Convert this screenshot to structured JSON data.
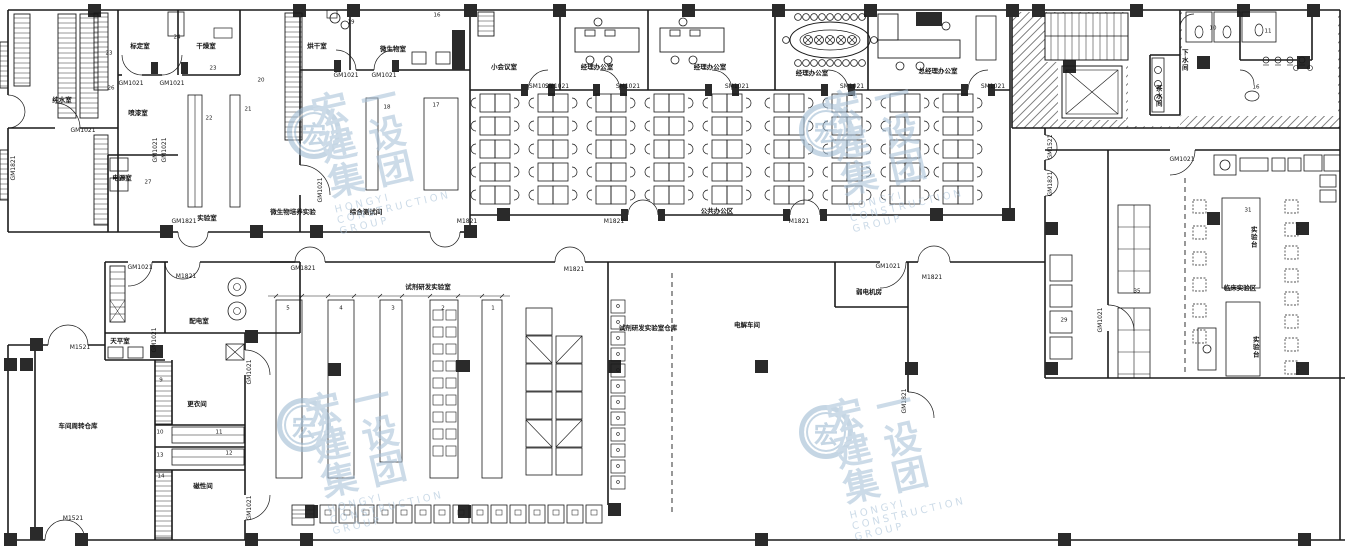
{
  "drawing": {
    "type": "architectural-floor-plan",
    "line_color": "#1a1a1a",
    "column_color": "#2a2a2a",
    "watermark_color": "#9db9d2"
  },
  "watermark": {
    "cn": "宏一建设集团",
    "en": "HONGYI CONSTRUCTION GROUP",
    "logo_char": "宏"
  },
  "labels": [
    {
      "k": "room",
      "t": "纯水室",
      "x": 62,
      "y": 100
    },
    {
      "k": "room",
      "t": "标定室",
      "x": 140,
      "y": 46
    },
    {
      "k": "room",
      "t": "干燥室",
      "x": 206,
      "y": 46
    },
    {
      "k": "room",
      "t": "喷漆室",
      "x": 138,
      "y": 113
    },
    {
      "k": "room",
      "t": "电源室",
      "x": 122,
      "y": 178
    },
    {
      "k": "room",
      "t": "实验室",
      "x": 207,
      "y": 218
    },
    {
      "k": "room",
      "t": "烘干室",
      "x": 317,
      "y": 46
    },
    {
      "k": "room",
      "t": "微生物室",
      "x": 393,
      "y": 49
    },
    {
      "k": "room",
      "t": "综合测试间",
      "x": 366,
      "y": 212
    },
    {
      "k": "room",
      "t": "微生物培养实验",
      "x": 293,
      "y": 212
    },
    {
      "k": "room",
      "t": "小会议室",
      "x": 504,
      "y": 67
    },
    {
      "k": "room",
      "t": "经理办公室",
      "x": 597,
      "y": 67
    },
    {
      "k": "room",
      "t": "经理办公室",
      "x": 710,
      "y": 67
    },
    {
      "k": "room",
      "t": "经理办公室",
      "x": 812,
      "y": 73
    },
    {
      "k": "room",
      "t": "总经理办公室",
      "x": 938,
      "y": 71
    },
    {
      "k": "room",
      "t": "公共办公区",
      "x": 717,
      "y": 211
    },
    {
      "k": "room",
      "t": "茶水间",
      "x": 1158,
      "y": 96,
      "v": 1
    },
    {
      "k": "room",
      "t": "下水间",
      "x": 1184,
      "y": 60,
      "v": 1
    },
    {
      "k": "room",
      "t": "临床实验区",
      "x": 1240,
      "y": 288
    },
    {
      "k": "room",
      "t": "实验台",
      "x": 1253,
      "y": 237,
      "v": 1
    },
    {
      "k": "room",
      "t": "实验台",
      "x": 1255,
      "y": 347,
      "v": 1
    },
    {
      "k": "room",
      "t": "天平室",
      "x": 120,
      "y": 341
    },
    {
      "k": "room",
      "t": "配电室",
      "x": 199,
      "y": 321
    },
    {
      "k": "room",
      "t": "车间周转仓库",
      "x": 78,
      "y": 426
    },
    {
      "k": "room",
      "t": "更衣间",
      "x": 197,
      "y": 404
    },
    {
      "k": "room",
      "t": "磁性间",
      "x": 203,
      "y": 486
    },
    {
      "k": "room",
      "t": "试剂研发实验室",
      "x": 428,
      "y": 287
    },
    {
      "k": "room",
      "t": "试剂研发实验室仓库",
      "x": 648,
      "y": 328
    },
    {
      "k": "room",
      "t": "电解车间",
      "x": 747,
      "y": 325
    },
    {
      "k": "room",
      "t": "弱电机房",
      "x": 869,
      "y": 292
    },
    {
      "k": "door",
      "t": "GM1021",
      "x": 131,
      "y": 84
    },
    {
      "k": "door",
      "t": "GM1021",
      "x": 172,
      "y": 84
    },
    {
      "k": "door",
      "t": "GM1021",
      "x": 83,
      "y": 131
    },
    {
      "k": "door",
      "t": "GM1821",
      "x": 14,
      "y": 168,
      "r": 1
    },
    {
      "k": "door",
      "t": "GM1021",
      "x": 156,
      "y": 150,
      "r": 1
    },
    {
      "k": "door",
      "t": "GM1021",
      "x": 165,
      "y": 150,
      "r": 1
    },
    {
      "k": "door",
      "t": "GM1821",
      "x": 184,
      "y": 222
    },
    {
      "k": "door",
      "t": "GM1021",
      "x": 321,
      "y": 190,
      "r": 1
    },
    {
      "k": "door",
      "t": "GM1021",
      "x": 346,
      "y": 76
    },
    {
      "k": "door",
      "t": "GM1021",
      "x": 384,
      "y": 76
    },
    {
      "k": "door",
      "t": "M1821",
      "x": 467,
      "y": 222
    },
    {
      "k": "door",
      "t": "SM1021",
      "x": 541,
      "y": 87
    },
    {
      "k": "door",
      "t": "SM1021",
      "x": 557,
      "y": 87
    },
    {
      "k": "door",
      "t": "SM1021",
      "x": 628,
      "y": 87
    },
    {
      "k": "door",
      "t": "SM1021",
      "x": 737,
      "y": 87
    },
    {
      "k": "door",
      "t": "SM1021",
      "x": 852,
      "y": 87
    },
    {
      "k": "door",
      "t": "SM1021",
      "x": 993,
      "y": 87
    },
    {
      "k": "door",
      "t": "M1821",
      "x": 614,
      "y": 222
    },
    {
      "k": "door",
      "t": "M1821",
      "x": 799,
      "y": 222
    },
    {
      "k": "door",
      "t": "GM1521",
      "x": 1051,
      "y": 147,
      "r": 1
    },
    {
      "k": "door",
      "t": "GM1821",
      "x": 1051,
      "y": 184,
      "r": 1
    },
    {
      "k": "door",
      "t": "GM1021",
      "x": 1182,
      "y": 160
    },
    {
      "k": "door",
      "t": "GM1021",
      "x": 1101,
      "y": 320,
      "r": 1
    },
    {
      "k": "door",
      "t": "GM1021",
      "x": 140,
      "y": 268
    },
    {
      "k": "door",
      "t": "M1821",
      "x": 186,
      "y": 277
    },
    {
      "k": "door",
      "t": "GM1021",
      "x": 155,
      "y": 340,
      "r": 1
    },
    {
      "k": "door",
      "t": "GM1021",
      "x": 250,
      "y": 372,
      "r": 1
    },
    {
      "k": "door",
      "t": "GM1021",
      "x": 250,
      "y": 508,
      "r": 1
    },
    {
      "k": "door",
      "t": "M1521",
      "x": 80,
      "y": 348
    },
    {
      "k": "door",
      "t": "M1521",
      "x": 73,
      "y": 519
    },
    {
      "k": "door",
      "t": "GM1821",
      "x": 303,
      "y": 269
    },
    {
      "k": "door",
      "t": "M1821",
      "x": 574,
      "y": 270
    },
    {
      "k": "door",
      "t": "GM1021",
      "x": 888,
      "y": 267
    },
    {
      "k": "door",
      "t": "M1821",
      "x": 932,
      "y": 278
    },
    {
      "k": "door",
      "t": "GM1821",
      "x": 905,
      "y": 401,
      "r": 1
    },
    {
      "k": "num",
      "t": "23",
      "x": 109,
      "y": 54
    },
    {
      "k": "num",
      "t": "24",
      "x": 177,
      "y": 38
    },
    {
      "k": "num",
      "t": "26",
      "x": 111,
      "y": 89
    },
    {
      "k": "num",
      "t": "23",
      "x": 213,
      "y": 69
    },
    {
      "k": "num",
      "t": "20",
      "x": 261,
      "y": 81
    },
    {
      "k": "num",
      "t": "22",
      "x": 209,
      "y": 119
    },
    {
      "k": "num",
      "t": "21",
      "x": 248,
      "y": 110
    },
    {
      "k": "num",
      "t": "27",
      "x": 148,
      "y": 183
    },
    {
      "k": "num",
      "t": "19",
      "x": 351,
      "y": 23
    },
    {
      "k": "num",
      "t": "16",
      "x": 437,
      "y": 16
    },
    {
      "k": "num",
      "t": "18",
      "x": 387,
      "y": 108
    },
    {
      "k": "num",
      "t": "17",
      "x": 436,
      "y": 106
    },
    {
      "k": "num",
      "t": "10",
      "x": 1213,
      "y": 29
    },
    {
      "k": "num",
      "t": "11",
      "x": 1268,
      "y": 32
    },
    {
      "k": "num",
      "t": "16",
      "x": 1256,
      "y": 88
    },
    {
      "k": "num",
      "t": "29",
      "x": 1064,
      "y": 321
    },
    {
      "k": "num",
      "t": "35",
      "x": 1137,
      "y": 292
    },
    {
      "k": "num",
      "t": "31",
      "x": 1248,
      "y": 211
    },
    {
      "k": "num",
      "t": "9",
      "x": 161,
      "y": 381
    },
    {
      "k": "num",
      "t": "10",
      "x": 160,
      "y": 433
    },
    {
      "k": "num",
      "t": "11",
      "x": 219,
      "y": 433
    },
    {
      "k": "num",
      "t": "13",
      "x": 160,
      "y": 456
    },
    {
      "k": "num",
      "t": "12",
      "x": 229,
      "y": 454
    },
    {
      "k": "num",
      "t": "14",
      "x": 161,
      "y": 477
    },
    {
      "k": "num",
      "t": "5",
      "x": 288,
      "y": 309
    },
    {
      "k": "num",
      "t": "4",
      "x": 341,
      "y": 309
    },
    {
      "k": "num",
      "t": "3",
      "x": 393,
      "y": 309
    },
    {
      "k": "num",
      "t": "2",
      "x": 443,
      "y": 309
    },
    {
      "k": "num",
      "t": "1",
      "x": 493,
      "y": 309
    }
  ]
}
